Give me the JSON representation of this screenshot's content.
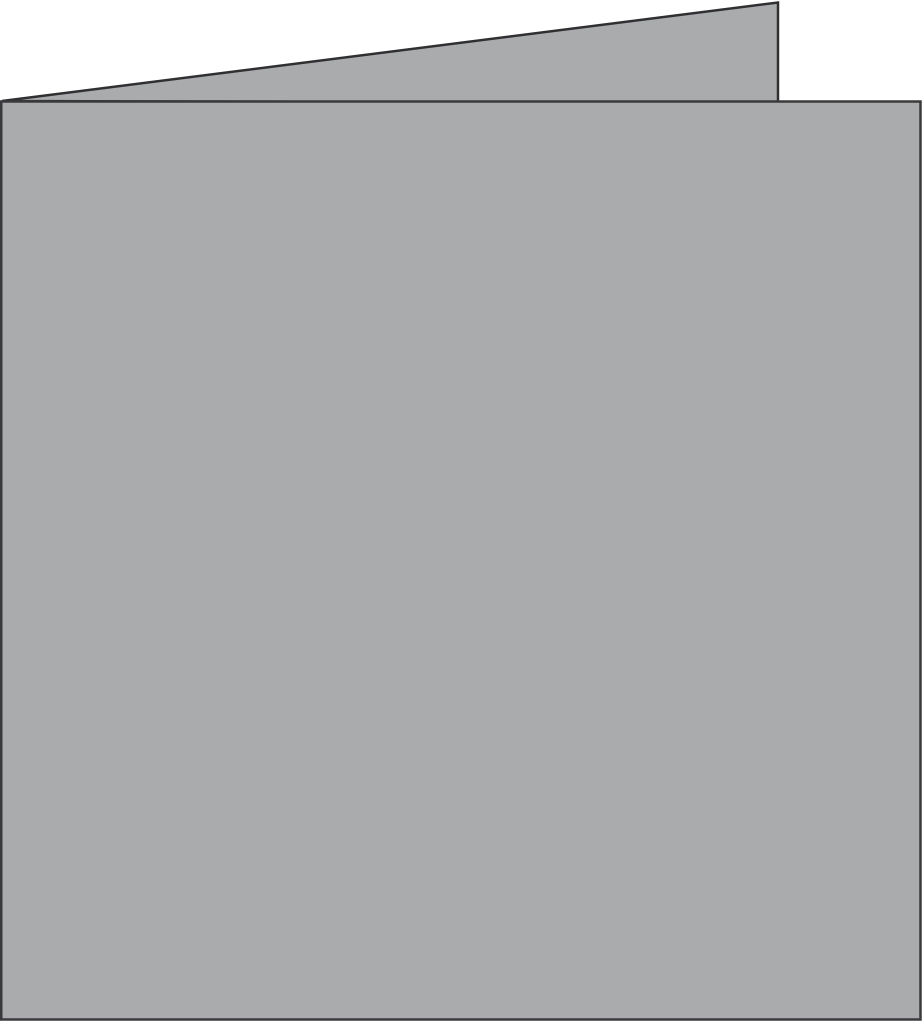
{
  "scene": {
    "background_color": "#ffffff"
  },
  "card": {
    "fill_color": "#a9abad",
    "outline_color": "#3a3a3c",
    "fold_outline_color": "#303032",
    "back_panel": {
      "points": "2,101 778,2.5 778,103",
      "stroke_width": "2.5"
    },
    "front_panel": {
      "x": "1.25",
      "y": "101.5",
      "width": "919.25",
      "height": "918",
      "stroke_width": "2.5"
    }
  }
}
